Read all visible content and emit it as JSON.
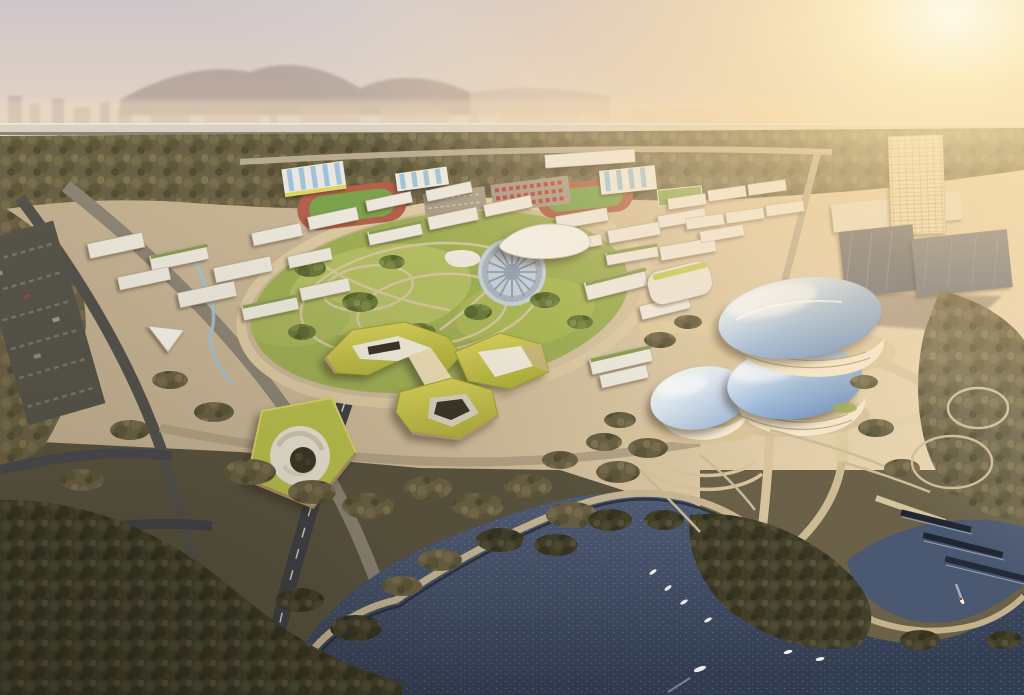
{
  "meta": {
    "description": "Aerial dusk architectural rendering of a lakeside campus masterplan",
    "style": "photorealistic architectural visualization",
    "view": "high oblique aerial",
    "lighting": "sunset, strong warm glow from upper right"
  },
  "palette": {
    "sky_top": "#cfc6c9",
    "sky_mid": "#e2d3c4",
    "sky_horizon": "#f3e2c0",
    "sun_core": "#fffbe9",
    "sun_glow": "#ffdfa3",
    "mountain": "#9c8a82",
    "city_haze": "#c8b4a6",
    "highway_deck": "#d9d2c2",
    "highway_shadow": "#8e8572",
    "forest_base": "#6b6145",
    "tree_dark_base": "#423f2a",
    "tree_green_base": "#6d7a3c",
    "campus_ground": "#cbb896",
    "ground_sun": "#e4d0a9",
    "road_light": "#dcc9a2",
    "road_mid": "#a3977f",
    "road_dark": "#414146",
    "lane_mark": "#d8d5cc",
    "building_roof": "#ece7db",
    "building_face": "#d9d2c2",
    "green_roof": "#8a9c50",
    "track_red": "#b2604b",
    "field_green": "#7ca24d",
    "court_blue": "#9ec3d8",
    "plaza_gray": "#c6cfd6",
    "plaza_pattern": "#8d9bab",
    "yellow_roof": "#c3c44a",
    "yellow_face": "#ecdcb4",
    "courtyard_white": "#efe9d9",
    "pit_dark": "#3c3627",
    "blob_band": "#f4e6ca",
    "water_deep": "#39445a",
    "water_mid": "#51607a",
    "boat_white": "#f2f4f4",
    "dark_slab": "#6d717c",
    "grid_tower": "#e9dcba",
    "dock_dark": "#1f2631",
    "stream_blue": "#a4c2ce",
    "stadium_roof_yellow": "#ded45f"
  },
  "scene": {
    "sky": [
      "hazy sunset sky",
      "mountain silhouettes",
      "distant city skyline",
      "sun glare upper right"
    ],
    "infrastructure": {
      "elevated_highway": 1,
      "highway_piers": 12
    },
    "campus": {
      "white_buildings": 40,
      "running_tracks": 2,
      "sawtooth_sports_halls": 3,
      "parking_lots": 3
    },
    "park": {
      "circular_plaza": 1,
      "lawn_loops": 3,
      "stream": 1
    },
    "signature_buildings": {
      "yellow_ring_complex": 3,
      "pentagon_courtyard_building": 1,
      "pebble_shaped_halls": 3,
      "glass_towers": 3,
      "wavy_canopy_building": 1,
      "tent_pavilion": 1
    },
    "waterfront": {
      "lake": 1,
      "boats": 8,
      "docks": 3,
      "foot_bridge": 1,
      "wooded_peninsula": 1,
      "side_pond": 1
    }
  }
}
